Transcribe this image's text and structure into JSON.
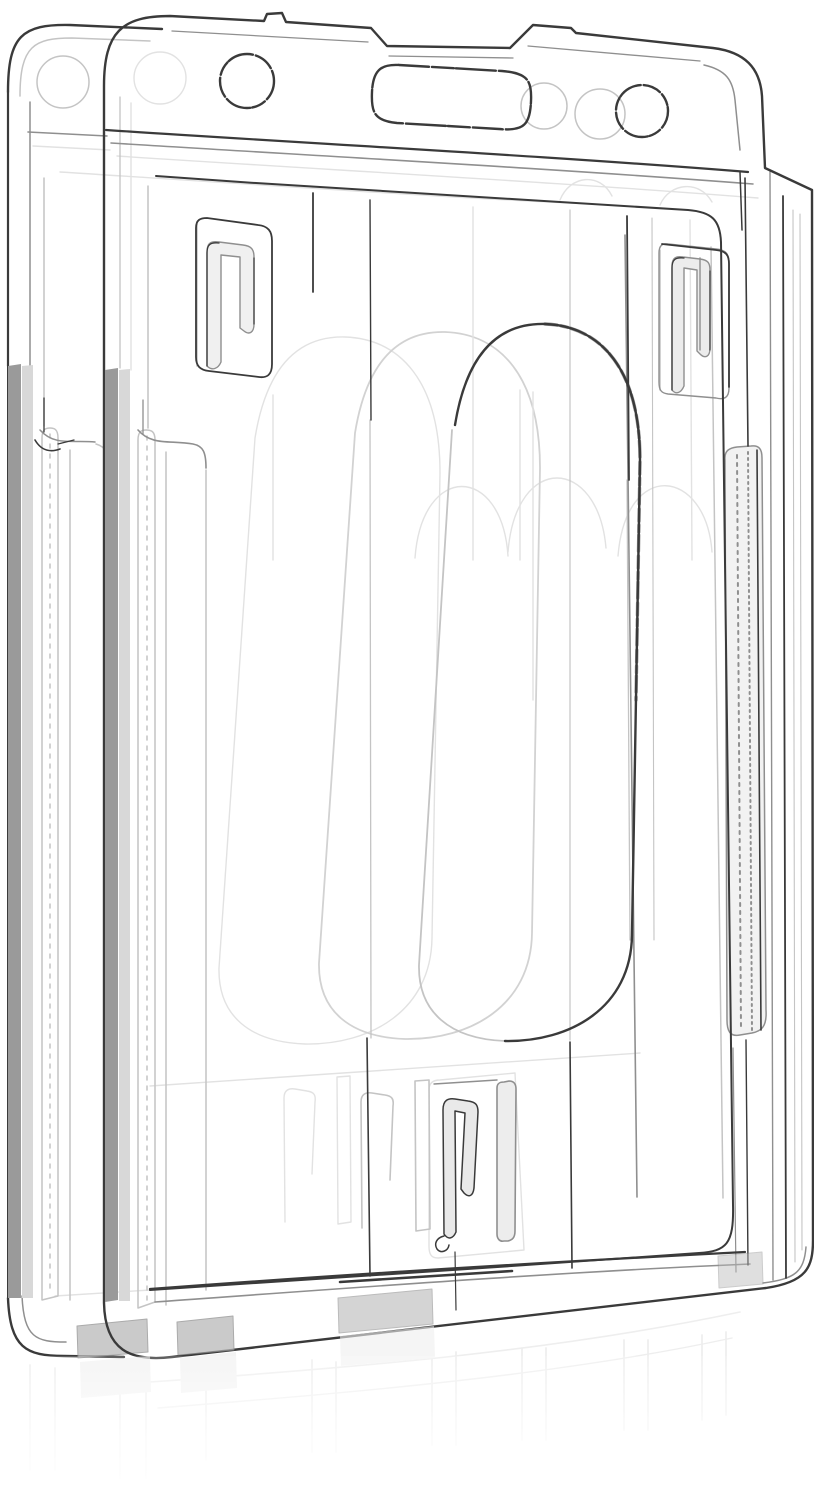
{
  "scene": {
    "type": "product-photo",
    "description": "Two clear transparent rigid plastic vertical ID badge card holders, stacked front-to-back with a slight left offset, photographed on a seamless white background with a faint floor reflection below",
    "item_count": 2,
    "background_color": "#ffffff"
  },
  "palette": {
    "ink": "#3a3a3a",
    "mid": "#8f8f8f",
    "light": "#c4c4c4",
    "faint": "#e2e2e2",
    "ghost": "#d2d2d2",
    "bar_gray": "#9a9a9a",
    "bar_light": "#d8d8d8",
    "tab_gray": "#b9b9b9",
    "reflection": "#e3e3e3",
    "background": "#ffffff"
  },
  "parts": {
    "front_holder": {
      "label": "front badge holder",
      "features": [
        "rounded top band with lanyard slot",
        "round lanyard hole left",
        "round lanyard hole right",
        "recessed notch on top edge",
        "two upper retention hooks",
        "large oval thumb slot",
        "lower retention hook and post",
        "textured side grip rails",
        "bottom card ledge with feet tabs"
      ]
    },
    "back_holder": {
      "label": "back badge holder",
      "features": [
        "rounded top band",
        "round lanyard hole",
        "side grip rails",
        "ghost outlines visible through front holder"
      ]
    },
    "reflection": {
      "label": "faint table reflection"
    }
  }
}
